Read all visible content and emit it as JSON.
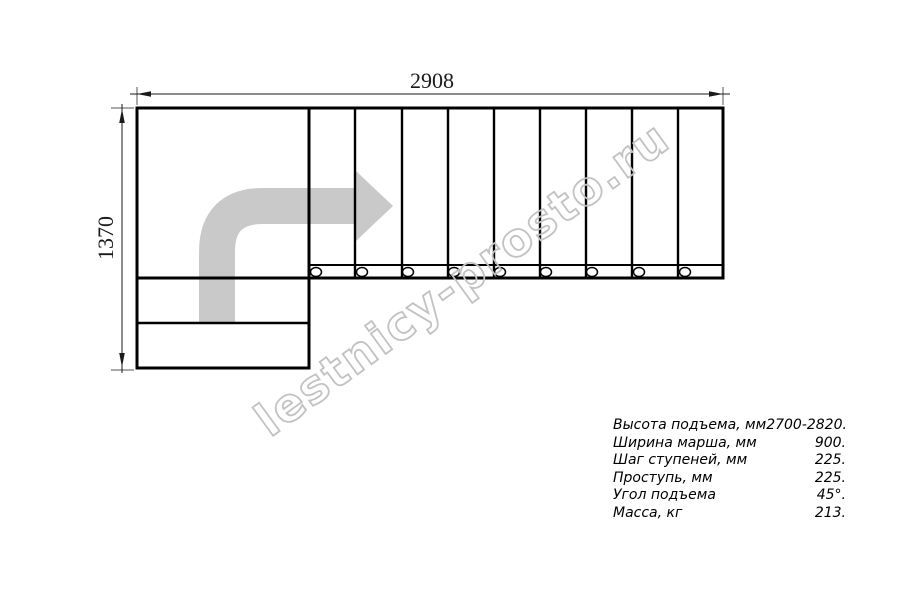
{
  "drawing": {
    "top_dimension_label": "2908",
    "left_dimension_label": "1370",
    "watermark_text": "lestnicy-prosto.ru",
    "tread_count": 9,
    "post_count": 9,
    "lower_step_count": 2,
    "colors": {
      "line": "#000000",
      "arrow_fill": "#c9c9c9",
      "watermark_stroke": "#c2c2c2"
    }
  },
  "specs": {
    "rows": [
      {
        "label": "Высота подъема, мм",
        "value": "2700-2820."
      },
      {
        "label": "Ширина марша, мм",
        "value": "900."
      },
      {
        "label": "Шаг ступеней, мм",
        "value": "225."
      },
      {
        "label": "Проступь, мм",
        "value": "225."
      },
      {
        "label": "Угол подъема",
        "value": "45°."
      },
      {
        "label": "Масса, кг",
        "value": "213."
      }
    ]
  }
}
